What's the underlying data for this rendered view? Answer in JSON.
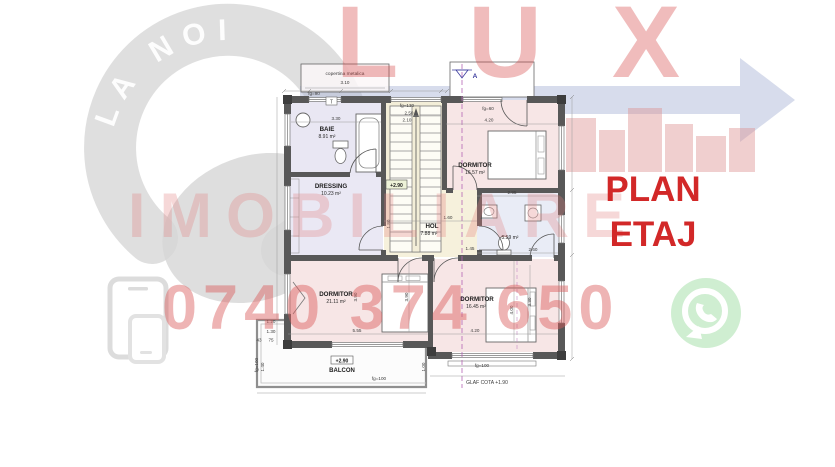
{
  "watermarks": {
    "brand_letters": "LUX",
    "brand_word": "IMOBILIARE",
    "arc_tagline": "CHEIA E LA NOI",
    "phone_number": "0740 374 650",
    "plan_title_line1": "PLAN",
    "plan_title_line2": "ETAJ",
    "colors": {
      "accent_red": "#d22828",
      "watermark_red": "#dd5c5c",
      "swoosh_blue": "#b0b9d9",
      "logo_gray": "#d9d9d9",
      "whatsapp_green": "#bfe8c1"
    }
  },
  "plan": {
    "rooms": [
      {
        "name": "BAIE",
        "area": "8.91 m²"
      },
      {
        "name": "DRESSING",
        "area": "10.23 m²"
      },
      {
        "name": "DORMITOR",
        "area": "16.57 m²"
      },
      {
        "name": "HOL",
        "area": "7.88 m²"
      },
      {
        "name": "",
        "area": "5.59 m²"
      },
      {
        "name": "DORMITOR",
        "area": "21.11 m²"
      },
      {
        "name": "DORMITOR",
        "area": "16.45 m²"
      },
      {
        "name": "BALCON",
        "area": ""
      }
    ],
    "annotations": {
      "canopy_label": "copertina metalica",
      "canopy_dim": "3.10",
      "stair_level": "+2.90",
      "balcony_level": "+2.90",
      "sill_note": "GLAF COTA +1.90",
      "section_mark": "A",
      "thermostat": "T"
    },
    "dims": [
      "fg=90",
      "3.30",
      "fg=130",
      "2.50",
      "2.10",
      "fg=60",
      "4.20",
      "1.80",
      "1.60",
      "1.45",
      "2.95",
      "2.60",
      "5.55",
      "4.20",
      "3.90",
      "4.00",
      "3.30",
      "1.20",
      "1.30",
      "43",
      "75",
      "fg=100",
      "1.40",
      "fg=100",
      "1.00",
      "fg=100",
      "3.90"
    ]
  }
}
